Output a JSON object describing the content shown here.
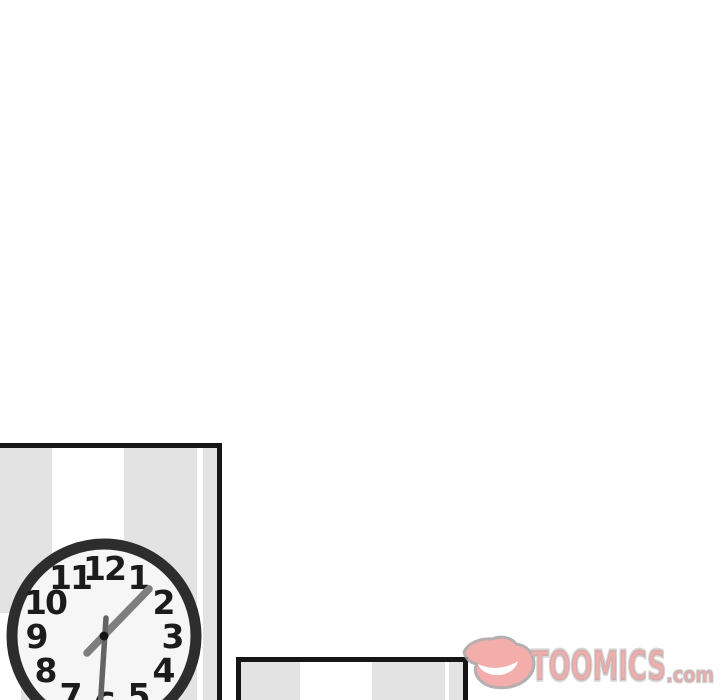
{
  "canvas": {
    "width": 720,
    "height": 700,
    "background_color": "#ffffff"
  },
  "comic": {
    "panel1": {
      "description": "wall-clock-panel",
      "border_color": "#161616",
      "stripe_gray": "#e3e3e3",
      "stripe_white": "#ffffff",
      "clock": {
        "numbers": [
          "12",
          "1",
          "2",
          "3",
          "4",
          "5",
          "6",
          "7",
          "8",
          "9",
          "10",
          "11"
        ],
        "face_color": "#f6f6f6",
        "ring_color": "#2d2d2d",
        "minute_hand_color": "#7e7e7e",
        "second_hand_color": "#646464",
        "center_dot_color": "#141414"
      }
    },
    "panel2": {
      "description": "striped-wall-panel-top-edge",
      "border_color": "#161616",
      "stripe_gray": "#e3e3e3",
      "stripe_white": "#ffffff"
    }
  },
  "watermark": {
    "brand": "TOOMICS",
    "suffix": ".com",
    "fill_color": "#f2a09d",
    "outline_color": "#a9a2a2",
    "mouth_color": "#ffffff"
  }
}
